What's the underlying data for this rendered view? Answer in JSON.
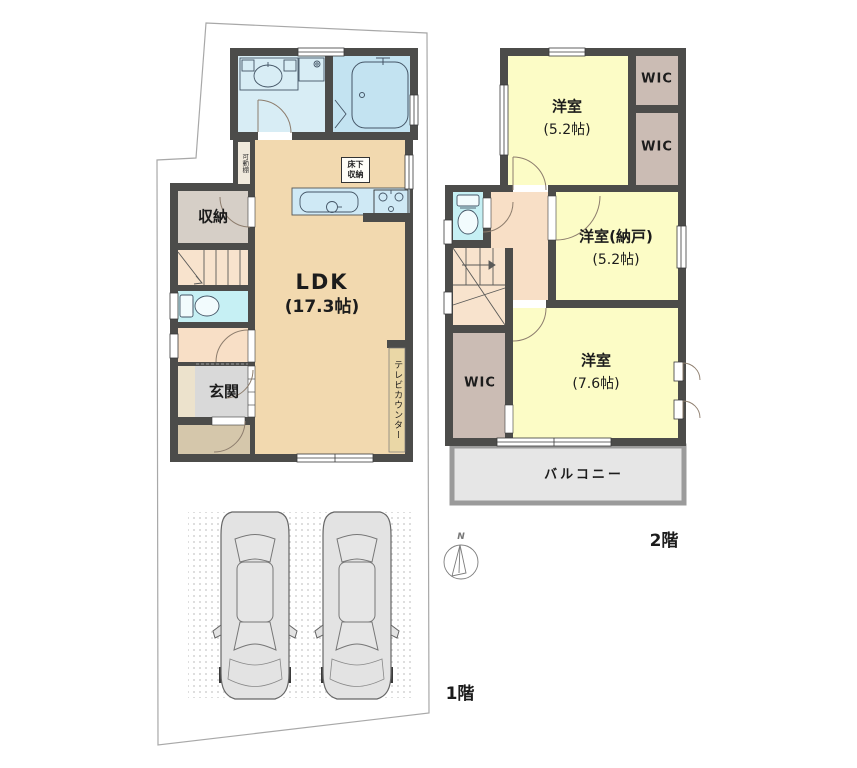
{
  "floor1": {
    "label": "1階",
    "ldk": {
      "name": "LDK",
      "size": "(17.3帖)"
    },
    "storage": "収納",
    "entrance": "玄関",
    "tv_counter": "テレビカウンター",
    "underfloor_line1": "床下",
    "underfloor_line2": "収納",
    "movable_shelf": "可動棚"
  },
  "floor2": {
    "label": "2階",
    "room_5_2": {
      "name": "洋室",
      "size": "(5.2帖)"
    },
    "room_nando": {
      "name": "洋室(納戸)",
      "size": "(5.2帖)"
    },
    "room_7_6": {
      "name": "洋室",
      "size": "(7.6帖)"
    },
    "wic1": "WIC",
    "wic2": "WIC",
    "wic3": "WIC",
    "balcony": "バルコニー"
  },
  "compass": {
    "north_label": "N"
  },
  "colors": {
    "wall": "#4c4c4a",
    "ldk_floor": "#f2d9af",
    "hall_stairs": "#f8dfc6",
    "washroom": "#d8edf5",
    "bathroom": "#c3e3f1",
    "kitchen_counter": "#cfe9f5",
    "toilet": "#c6f0f4",
    "storage_gray": "#d6cfc7",
    "wic_brown": "#cbbcb4",
    "entrance_gray": "#d9d9d9",
    "porch_tan": "#d5c7ab",
    "room_yellow": "#fcfcc6",
    "balcony_fill": "#e6e6e6",
    "balcony_border": "#9b9b9b",
    "car_body": "#e3e3e3",
    "site_line": "#a8a8a8"
  }
}
